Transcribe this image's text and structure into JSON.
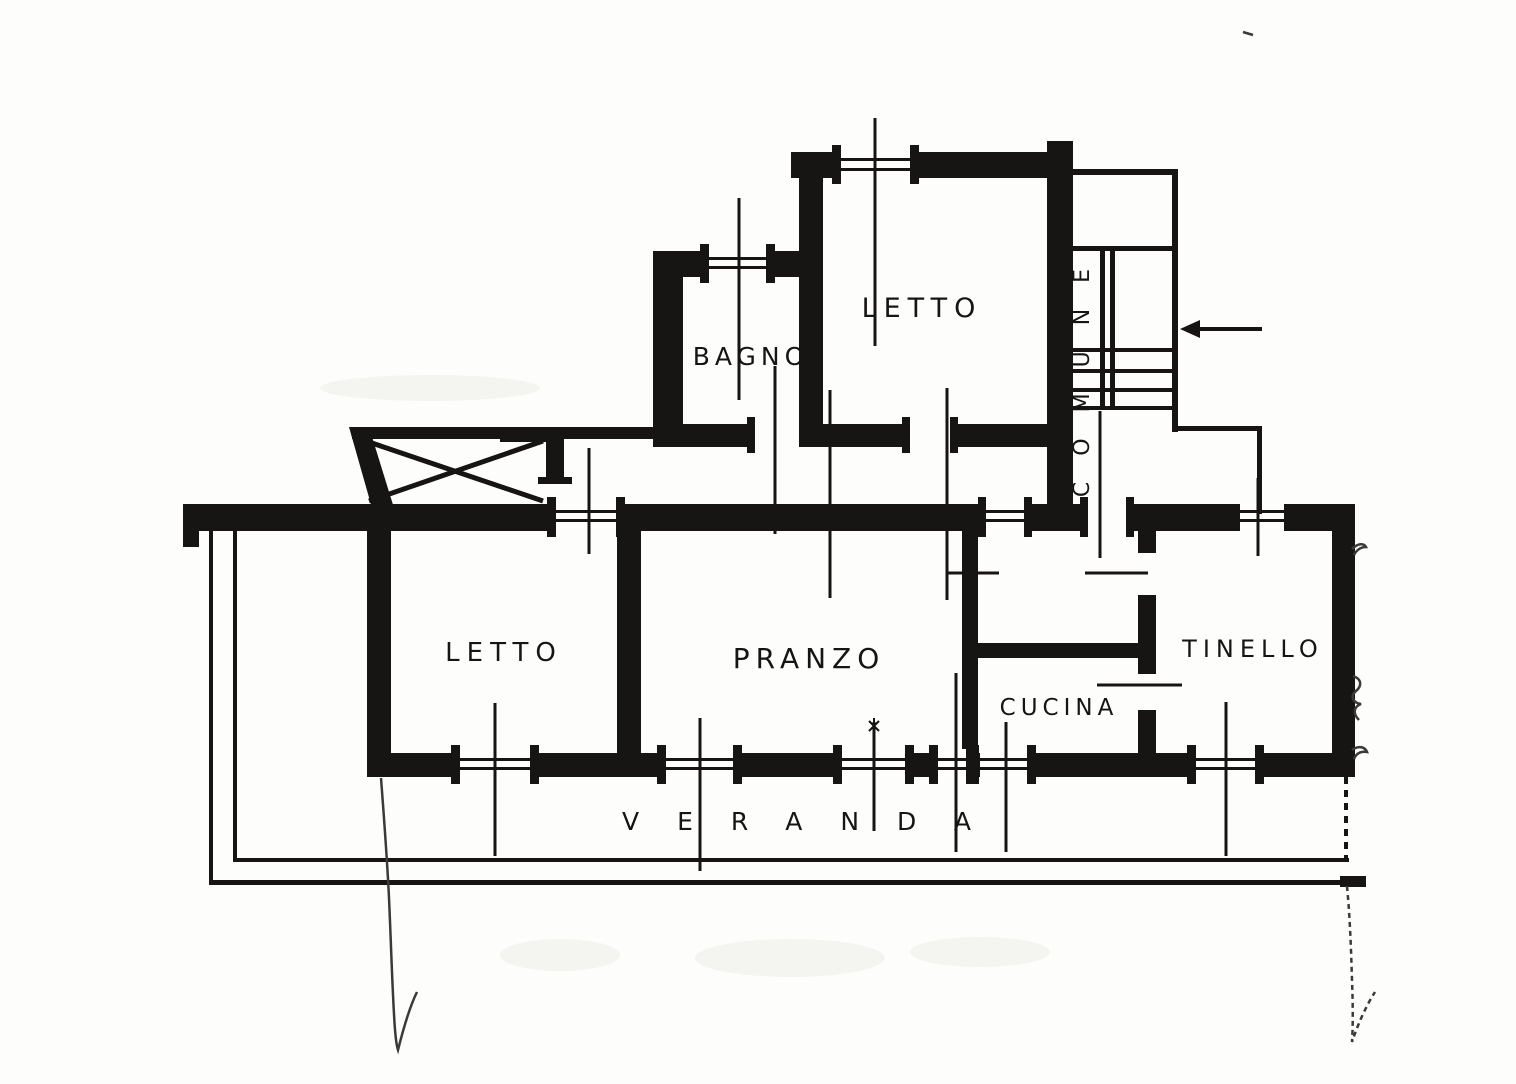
{
  "page": {
    "kind": "scanned hand-drawn apartment floor plan",
    "colors": {
      "paper": "#fdfdfb",
      "ink": "#161514",
      "pencil": "#3c3a36"
    }
  },
  "plan": {
    "rooms": [
      {
        "id": "letto-top",
        "label": "LETTO"
      },
      {
        "id": "bagno",
        "label": "BAGNO"
      },
      {
        "id": "letto-left",
        "label": "LETTO"
      },
      {
        "id": "pranzo",
        "label": "PRANZO"
      },
      {
        "id": "cucina",
        "label": "CUCINA"
      },
      {
        "id": "tinello",
        "label": "TINELLO"
      }
    ],
    "veranda_label": "VERANDA",
    "stairwell_label": "COMUNE",
    "icons": {
      "entry_arrow": "left-pointing-entry-arrow",
      "shaft": "crossed-shaft-box",
      "stairs": "common-staircase-treads"
    }
  }
}
